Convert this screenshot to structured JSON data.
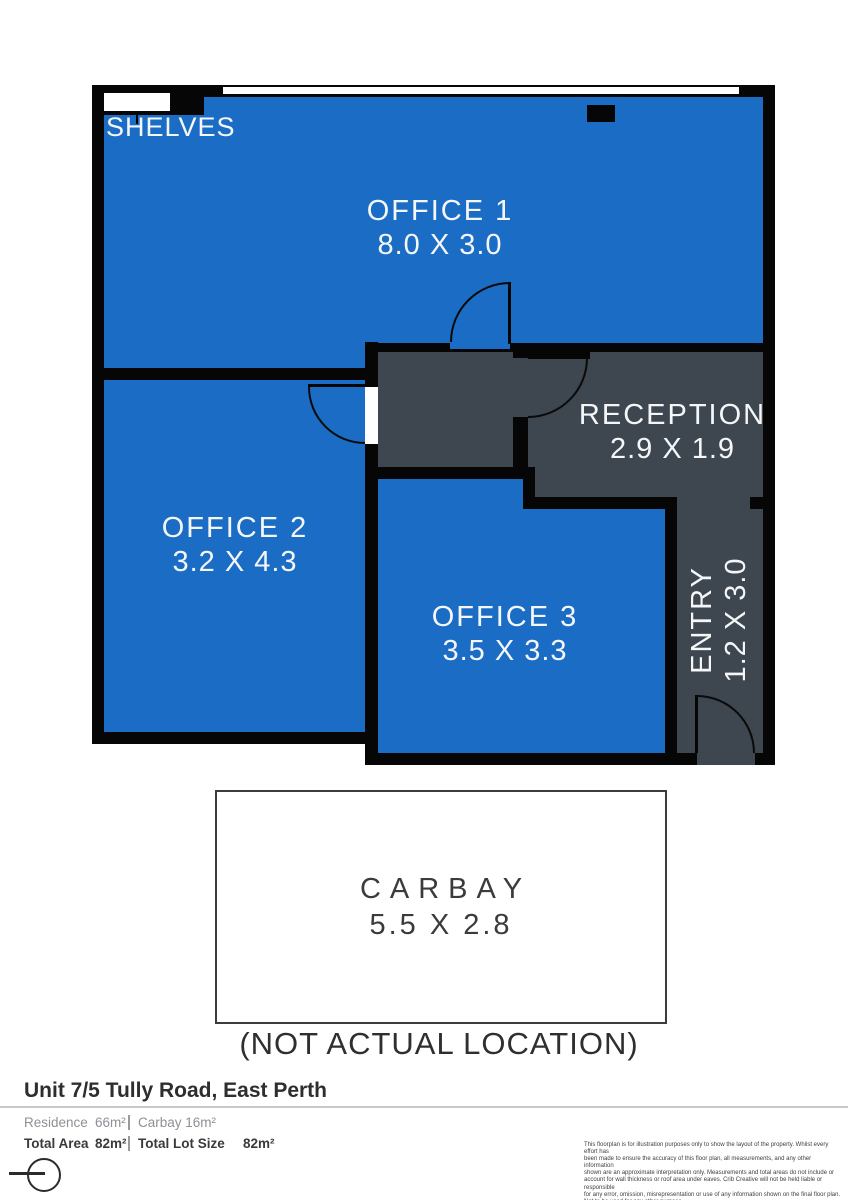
{
  "floorplan": {
    "shelves_label": "SHELVES",
    "office1": {
      "name": "OFFICE 1",
      "dims": "8.0 X 3.0"
    },
    "office2": {
      "name": "OFFICE 2",
      "dims": "3.2 X 4.3"
    },
    "office3": {
      "name": "OFFICE 3",
      "dims": "3.5 X 3.3"
    },
    "reception": {
      "name": "RECEPTION",
      "dims": "2.9 X 1.9"
    },
    "entry": {
      "name": "ENTRY",
      "dims": "1.2 X 3.0"
    },
    "carbay": {
      "name": "CARBAY",
      "dims": "5.5 X 2.8",
      "note": "(NOT ACTUAL LOCATION)"
    },
    "colors": {
      "room_blue": "#1A6CC4",
      "zone_gray": "#3E4650",
      "wall_black": "#060606"
    }
  },
  "footer": {
    "address": "Unit 7/5 Tully Road, East Perth",
    "residence_label": "Residence",
    "residence_value": "66m²",
    "carbay_summary": "Carbay 16m²",
    "total_area_label": "Total Area",
    "total_area_value": "82m²",
    "total_lot_label": "Total Lot Size",
    "total_lot_value": "82m²",
    "disclaimer": [
      "This floorplan is for illustration purposes only to show the layout of the property. Whilst every effort has",
      "been made to ensure the accuracy of this floor plan, all measurements, and any other information",
      "shown are an approximate interpretation only. Measurements and total areas do not include or",
      "account for wall thickness or roof area under eaves. Crib Creative will not be held liable or responsible",
      "for any error, omission, misrepresentation or use of any information shown on the final floor plan.",
      "Not to be used for any other purpose.",
      "www.cribcreative.com.au"
    ]
  }
}
